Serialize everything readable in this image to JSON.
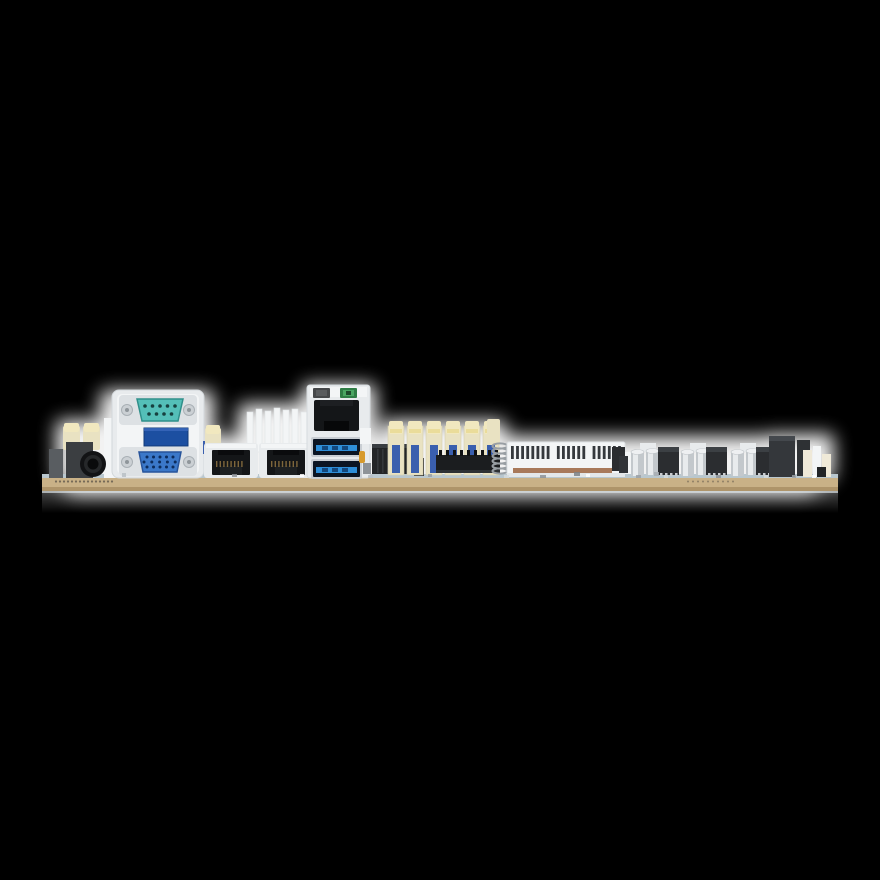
{
  "image": {
    "kind": "product-photo",
    "subject": "motherboard-rear-io-edge-view",
    "background": "#000000"
  },
  "palette": {
    "glow": "#ffffff",
    "pcb": "#c9b187",
    "pcb_dark": "#a78d63",
    "pcb_edge": "#b9c7ce",
    "metal_bracket": "#e8ebed",
    "metal_light": "#f3f5f6",
    "metal_mid": "#dde1e4",
    "metal_dark": "#c9ced3",
    "serial_teal": "#54bfb8",
    "serial_teal_dark": "#2f8f8a",
    "vga_blue": "#3b78c9",
    "vga_blue_dark": "#27549b",
    "hole_blue": "#0d2c5c",
    "usb_blue": "#2e8ed8",
    "usb_slot": "#0b1523",
    "mid_blue": "#1c4fa1",
    "port_black": "#141618",
    "chip_black": "#2b2d30",
    "box_black": "#232527",
    "led_green": "#4aa662",
    "led_green_dark": "#2f7d45",
    "led_gray": "#46484a",
    "cream": "#e9e2c2",
    "cream_cap": "#f1e8bf",
    "cream_yellow": "#eadc9a",
    "latch_blue": "#3a5fae",
    "cap_silver": "#c3c8cc",
    "cap_highlight": "#e8ebed",
    "cap_top": "#eef0f2",
    "copper": "#a8795a",
    "amber": "#d79a2c",
    "coil": "#989ea3",
    "slab_gray": "#595d61",
    "slab_dark": "#3b3e41",
    "white_cream": "#efe9d8",
    "gold": "#8a6f3f",
    "pin_dark": "#17403f"
  },
  "components": {
    "audio_jack": "barrel-jack",
    "serial_port": "db9-serial-male-teal",
    "vga_port": "de15-vga-female-blue",
    "ethernet_ports": 2,
    "stacked_lan_usb": {
      "lan_ports": 1,
      "usb3_ports": 2,
      "leds": [
        "dark",
        "green"
      ]
    },
    "white_latch_connectors": 6,
    "pin_header": 1,
    "coil_spring": 1,
    "slot_edge": "white-slotted-connector",
    "vrm_capacitor_pairs": 3,
    "vrm_chokes": 3,
    "right_io_chips": 2
  }
}
